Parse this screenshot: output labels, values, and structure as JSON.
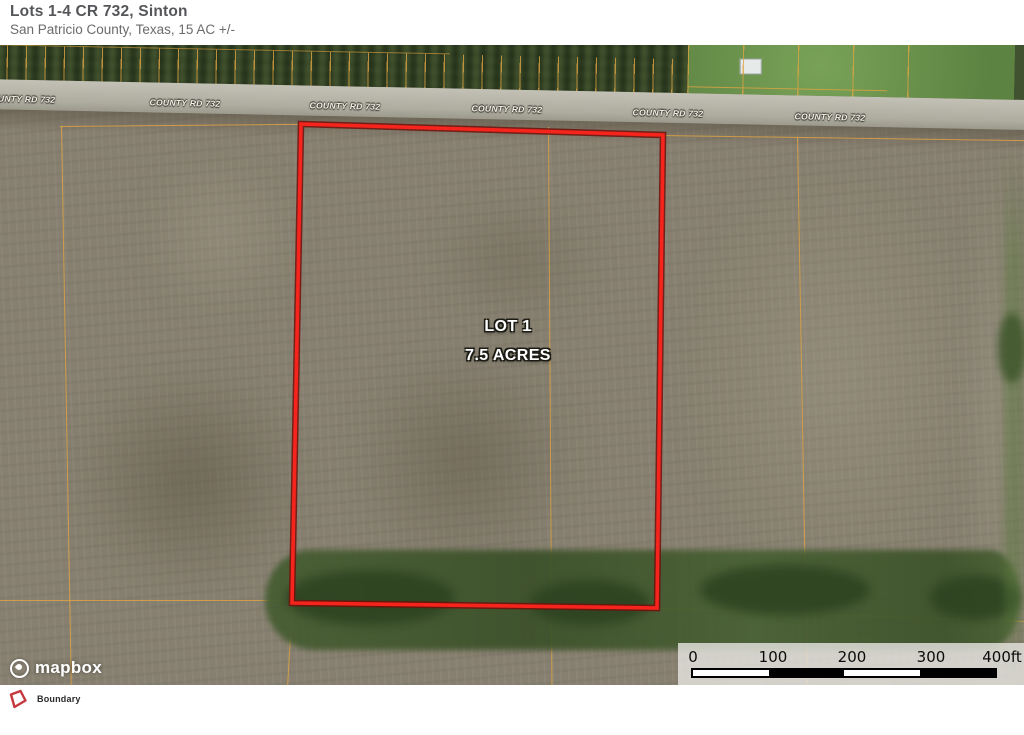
{
  "header": {
    "title": "Lots 1-4 CR 732, Sinton",
    "subtitle": "San Patricio County, Texas, 15 AC +/-"
  },
  "map": {
    "road_label": "COUNTY RD 732",
    "lot": {
      "name": "LOT 1",
      "area": "7.5 ACRES"
    },
    "attribution": "mapbox",
    "scale": {
      "ticks": [
        "0",
        "100",
        "200",
        "300",
        "400ft"
      ]
    }
  },
  "legend": {
    "items": [
      {
        "label": "Boundary",
        "color": "#c7383e"
      }
    ]
  },
  "colors": {
    "boundary_stroke": "#f5241c",
    "boundary_halo": "#70100a",
    "parcel_line": "#dda243",
    "field": "#878070",
    "road": "#b3b1a4",
    "trees": "#3c4a2b"
  }
}
